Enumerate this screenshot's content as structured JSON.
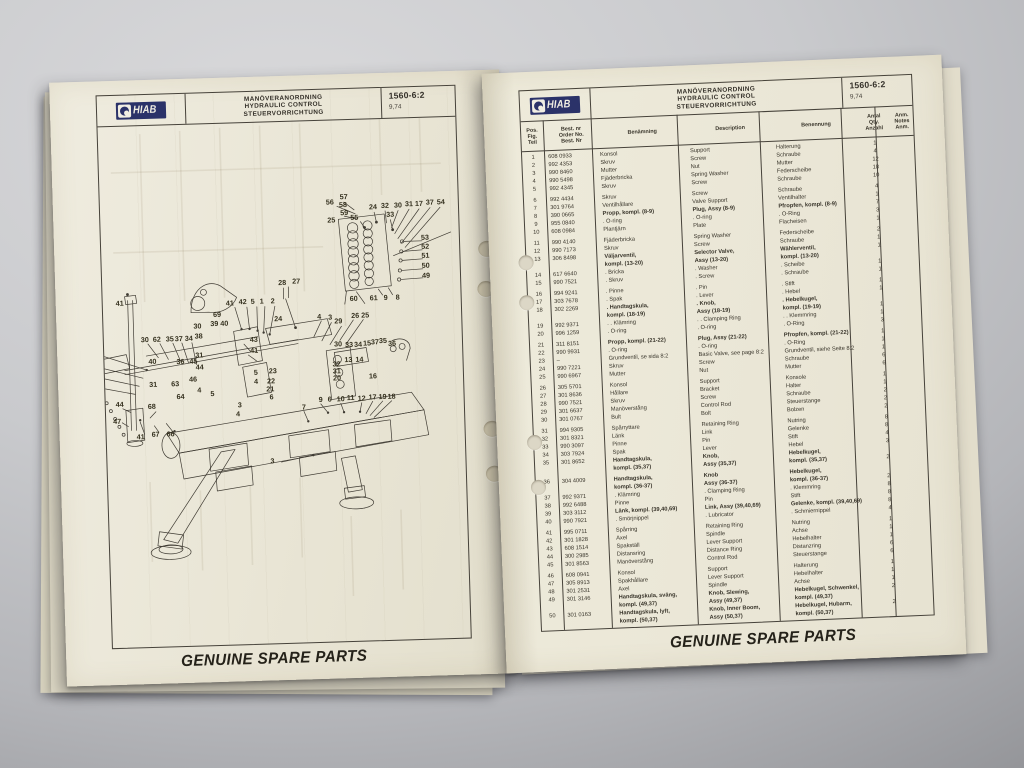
{
  "brand": {
    "logo_text": "HIAB",
    "logo_color": "#2b3269"
  },
  "header": {
    "title_sv": "MANÖVERANORDNING",
    "title_en": "HYDRAULIC CONTROL",
    "title_de": "STEUERVORRICHTUNG",
    "doc_no": "1560-6:2",
    "doc_date": "9,74"
  },
  "footer": {
    "slogan": "GENUINE SPARE PARTS"
  },
  "table": {
    "col_headers": {
      "pos": [
        "Pos.",
        "Fig.",
        "Teil"
      ],
      "no": [
        "Best. nr",
        "Order No.",
        "Best. Nr"
      ],
      "sv": "Benämning",
      "en": "Description",
      "de": "Benennung",
      "qty": [
        "Antal",
        "Qty.",
        "Anzahl"
      ],
      "anm": [
        "Anm.",
        "Notes",
        "Anm."
      ]
    },
    "rows": [
      {
        "pos": "1",
        "no": "608 0933",
        "sv": "Konsol",
        "en": "Support",
        "de": "Halterung",
        "qty": "1"
      },
      {
        "pos": "2",
        "no": "992 4353",
        "sv": "Skruv",
        "en": "Screw",
        "de": "Schraube",
        "qty": "4"
      },
      {
        "pos": "3",
        "no": "990 8460",
        "sv": "Mutter",
        "en": "Nut",
        "de": "Mutter",
        "qty": "12"
      },
      {
        "pos": "4",
        "no": "990 5498",
        "sv": "Fjäderbricka",
        "en": "Spring Washer",
        "de": "Federscheibe",
        "qty": "18"
      },
      {
        "pos": "5",
        "no": "992 4345",
        "sv": "Skruv",
        "en": "Screw",
        "de": "Schraube",
        "qty": "10"
      },
      {
        "gap": 1
      },
      {
        "pos": "6",
        "no": "992 4434",
        "sv": "Skruv",
        "en": "Screw",
        "de": "Schraube",
        "qty": "4"
      },
      {
        "pos": "7",
        "no": "301 9764",
        "sv": "Ventilhållare",
        "en": "Valve Support",
        "de": "Ventilhalter",
        "qty": "1"
      },
      {
        "pos": "8",
        "no": "390 0665",
        "sv": "Propp, kompl. (8-9)",
        "en": "Plug, Assy (8-9)",
        "de": "Pfropfen, kompl. (8-9)",
        "qty": "7",
        "b": 1
      },
      {
        "pos": "9",
        "no": "955 0840",
        "sv": ". O-ring",
        "en": ". O-ring",
        "de": ". O-Ring",
        "qty": "3"
      },
      {
        "pos": "10",
        "no": "608 0984",
        "sv": "Plantjärn",
        "en": "Plate",
        "de": "Flacheisen",
        "qty": "1"
      },
      {
        "gap": 1
      },
      {
        "pos": "11",
        "no": "990 4140",
        "sv": "Fjäderbricka",
        "en": "Spring Washer",
        "de": "Federscheibe",
        "qty": "2"
      },
      {
        "pos": "12",
        "no": "990 7173",
        "sv": "Skruv",
        "en": "Screw",
        "de": "Schraube",
        "qty": "1"
      },
      {
        "pos": "13",
        "no": "306 8498",
        "sv": "Väljarventil,",
        "en": "Selector Valve,",
        "de": "Wählerventil,",
        "qty": "1",
        "b": 1
      },
      {
        "pos": "",
        "no": "",
        "sv": "kompl. (13-20)",
        "en": "Assy (13-20)",
        "de": "kompl. (13-20)",
        "qty": "",
        "b": 1
      },
      {
        "pos": "14",
        "no": "617 6640",
        "sv": ". Bricka",
        "en": ". Washer",
        "de": ". Scheibe",
        "qty": "1"
      },
      {
        "pos": "15",
        "no": "990 7521",
        "sv": ". Skruv",
        "en": ". Screw",
        "de": ". Schraube",
        "qty": "1"
      },
      {
        "gap": 1
      },
      {
        "pos": "16",
        "no": "994 9241",
        "sv": ". Pinne",
        "en": ". Pin",
        "de": ". Stift",
        "qty": "1"
      },
      {
        "pos": "17",
        "no": "303 7678",
        "sv": ". Spak",
        "en": ". Lever",
        "de": ". Hebel",
        "qty": "1"
      },
      {
        "pos": "18",
        "no": "302 2269",
        "sv": ". Handtagskula,",
        "en": ". Knob,",
        "de": ". Hebelkugel,",
        "qty": "",
        "b": 1
      },
      {
        "pos": "",
        "no": "",
        "sv": "kompl. (18-19)",
        "en": "Assy (18-19)",
        "de": "kompl. (19-19)",
        "qty": "1",
        "b": 1
      },
      {
        "pos": "19",
        "no": "992 9371",
        "sv": ". . Klämring",
        "en": ". . Clamping Ring",
        "de": ". . Klemmring",
        "qty": "1"
      },
      {
        "pos": "20",
        "no": "996 1259",
        "sv": ". O-ring",
        "en": ". O-ring",
        "de": ". O-Ring",
        "qty": "3"
      },
      {
        "gap": 1
      },
      {
        "pos": "21",
        "no": "311 8151",
        "sv": "Propp, kompl. (21-22)",
        "en": "Plug, Assy (21-22)",
        "de": "Pfropfen, kompl. (21-22)",
        "qty": "1",
        "b": 1
      },
      {
        "pos": "22",
        "no": "990 9931",
        "sv": ". O-ring",
        "en": ". O-ring",
        "de": ". O-Ring",
        "qty": "1"
      },
      {
        "pos": "23",
        "no": "–",
        "sv": "Grundventil, se sida 8:2",
        "en": "Basic Valve, see page 8:2",
        "de": "Grundventil, siehe Seite 8:2",
        "qty": "1"
      },
      {
        "pos": "24",
        "no": "990 7221",
        "sv": "Skruv",
        "en": "Screw",
        "de": "Schraube",
        "qty": "6"
      },
      {
        "pos": "25",
        "no": "990 6967",
        "sv": "Mutter",
        "en": "Nut",
        "de": "Mutter",
        "qty": "6"
      },
      {
        "gap": 1
      },
      {
        "pos": "26",
        "no": "305 5701",
        "sv": "Konsol",
        "en": "Support",
        "de": "Konsole",
        "qty": "1"
      },
      {
        "pos": "27",
        "no": "301 8636",
        "sv": "Hållare",
        "en": "Bracket",
        "de": "Halter",
        "qty": "1"
      },
      {
        "pos": "28",
        "no": "990 7521",
        "sv": "Skruv",
        "en": "Screw",
        "de": "Schraube",
        "qty": "2"
      },
      {
        "pos": "29",
        "no": "301 6637",
        "sv": "Manöverstång",
        "en": "Control Rod",
        "de": "Steuerstange",
        "qty": "2"
      },
      {
        "pos": "30",
        "no": "301 0767",
        "sv": "Bult",
        "en": "Bolt",
        "de": "Bolzen",
        "qty": "2"
      },
      {
        "gap": 1
      },
      {
        "pos": "31",
        "no": "994 9305",
        "sv": "Spårryttare",
        "en": "Retaining Ring",
        "de": "Nutring",
        "qty": "8"
      },
      {
        "pos": "32",
        "no": "301 8321",
        "sv": "Länk",
        "en": "Link",
        "de": "Gelenke",
        "qty": "8"
      },
      {
        "pos": "33",
        "no": "990 3097",
        "sv": "Pinne",
        "en": "Pin",
        "de": "Stift",
        "qty": "4"
      },
      {
        "pos": "34",
        "no": "303 7924",
        "sv": "Spak",
        "en": "Lever",
        "de": "Hebel",
        "qty": "3"
      },
      {
        "pos": "35",
        "no": "301 8652",
        "sv": "Handtagskula,",
        "en": "Knob,",
        "de": "Hebelkugel,",
        "qty": "",
        "b": 1
      },
      {
        "pos": "",
        "no": "",
        "sv": "kompl. (35,37)",
        "en": "Assy (35,37)",
        "de": "kompl. (35,37)",
        "qty": "2",
        "b": 1
      },
      {
        "gap": 1
      },
      {
        "pos": "36",
        "no": "304 4009",
        "sv": "Handtagskula,",
        "en": "Knob",
        "de": "Hebelkugel,",
        "qty": "",
        "b": 1
      },
      {
        "pos": "",
        "no": "",
        "sv": "kompl. (36-37)",
        "en": "Assy (36-37)",
        "de": "kompl. (36-37)",
        "qty": "2",
        "b": 1
      },
      {
        "pos": "37",
        "no": "992 9371",
        "sv": ". Klämring",
        "en": ". Clamping Ring",
        "de": ". Klemmring",
        "qty": "8"
      },
      {
        "pos": "38",
        "no": "992 6488",
        "sv": "Pinne",
        "en": "Pin",
        "de": "Stift",
        "qty": "8"
      },
      {
        "pos": "39",
        "no": "303 3112",
        "sv": "Länk, kompl. (39,40,69)",
        "en": "Link, Assy (39,40,69)",
        "de": "Gelenke, kompl. (39,40,69)",
        "qty": "8",
        "b": 1
      },
      {
        "pos": "40",
        "no": "990 7921",
        "sv": ". Smörjnippel",
        "en": ". Lubricator",
        "de": ". Schmiernippel",
        "qty": "4"
      },
      {
        "gap": 1
      },
      {
        "pos": "41",
        "no": "995 0711",
        "sv": "Spårring",
        "en": "Retaining Ring",
        "de": "Nutring",
        "qty": "1"
      },
      {
        "pos": "42",
        "no": "301 1828",
        "sv": "Axel",
        "en": "Spindle",
        "de": "Achse",
        "qty": "1"
      },
      {
        "pos": "43",
        "no": "608 1514",
        "sv": "Spakställ",
        "en": "Lever Support",
        "de": "Hebelhalter",
        "qty": "1"
      },
      {
        "pos": "44",
        "no": "300 2985",
        "sv": "Distansring",
        "en": "Distance Ring",
        "de": "Distanzring",
        "qty": "6"
      },
      {
        "pos": "45",
        "no": "301 8563",
        "sv": "Manöverstång",
        "en": "Control Rod",
        "de": "Steuerstange",
        "qty": "6"
      },
      {
        "gap": 1
      },
      {
        "pos": "46",
        "no": "608 0941",
        "sv": "Konsol",
        "en": "Support",
        "de": "Halterung",
        "qty": "1"
      },
      {
        "pos": "47",
        "no": "305 8913",
        "sv": "Spakhållare",
        "en": "Lever Support",
        "de": "Hebelhalter",
        "qty": "1"
      },
      {
        "pos": "48",
        "no": "301 2531",
        "sv": "Axel",
        "en": "Spindle",
        "de": "Achse",
        "qty": "1"
      },
      {
        "pos": "49",
        "no": "301 3146",
        "sv": "Handtagskula, sväng,",
        "en": "Knob, Slewing,",
        "de": "Hebelkugel, Schwenkel,",
        "qty": "2",
        "b": 1
      },
      {
        "pos": "",
        "no": "",
        "sv": "kompl. (49,37)",
        "en": "Assy (49,37)",
        "de": "kompl. (49,37)",
        "qty": "",
        "b": 1
      },
      {
        "pos": "50",
        "no": "301 0163",
        "sv": "Handtagskula, lyft,",
        "en": "Knob, Inner Boom,",
        "de": "Hebelkugel, Hubarm,",
        "qty": "2",
        "b": 1
      },
      {
        "pos": "",
        "no": "",
        "sv": "kompl. (50,37)",
        "en": "Assy (50,37)",
        "de": "kompl. (50,37)",
        "qty": "",
        "b": 1
      }
    ]
  },
  "diagram": {
    "callouts": [
      {
        "t": "56",
        "x": 338,
        "y": 208
      },
      {
        "t": "57",
        "x": 352,
        "y": 203
      },
      {
        "t": "58",
        "x": 351,
        "y": 211
      },
      {
        "t": "59",
        "x": 352,
        "y": 219
      },
      {
        "t": "25",
        "x": 339,
        "y": 226
      },
      {
        "t": "55",
        "x": 362,
        "y": 224
      },
      {
        "t": "24",
        "x": 381,
        "y": 214
      },
      {
        "t": "32",
        "x": 393,
        "y": 213
      },
      {
        "t": "30",
        "x": 406,
        "y": 213
      },
      {
        "t": "31",
        "x": 417,
        "y": 212
      },
      {
        "t": "17",
        "x": 427,
        "y": 212
      },
      {
        "t": "37",
        "x": 438,
        "y": 211
      },
      {
        "t": "54",
        "x": 449,
        "y": 211
      },
      {
        "t": "33",
        "x": 398,
        "y": 222
      },
      {
        "t": "53",
        "x": 432,
        "y": 246
      },
      {
        "t": "52",
        "x": 432,
        "y": 255
      },
      {
        "t": "51",
        "x": 432,
        "y": 264
      },
      {
        "t": "50",
        "x": 432,
        "y": 274
      },
      {
        "t": "49",
        "x": 432,
        "y": 284
      },
      {
        "t": "60",
        "x": 359,
        "y": 305
      },
      {
        "t": "61",
        "x": 379,
        "y": 305
      },
      {
        "t": "9",
        "x": 391,
        "y": 305
      },
      {
        "t": "8",
        "x": 403,
        "y": 305
      },
      {
        "t": "28",
        "x": 288,
        "y": 287
      },
      {
        "t": "27",
        "x": 302,
        "y": 286
      },
      {
        "t": "41",
        "x": 125,
        "y": 303
      },
      {
        "t": "69",
        "x": 222,
        "y": 317
      },
      {
        "t": "41",
        "x": 235,
        "y": 306
      },
      {
        "t": "42",
        "x": 248,
        "y": 305
      },
      {
        "t": "5",
        "x": 258,
        "y": 305
      },
      {
        "t": "1",
        "x": 267,
        "y": 305
      },
      {
        "t": "2",
        "x": 278,
        "y": 305
      },
      {
        "t": "24",
        "x": 283,
        "y": 323
      },
      {
        "t": "30",
        "x": 202,
        "y": 328
      },
      {
        "t": "39",
        "x": 219,
        "y": 326
      },
      {
        "t": "40",
        "x": 229,
        "y": 326
      },
      {
        "t": "38",
        "x": 203,
        "y": 338
      },
      {
        "t": "4",
        "x": 324,
        "y": 322
      },
      {
        "t": "3",
        "x": 335,
        "y": 323
      },
      {
        "t": "29",
        "x": 343,
        "y": 327
      },
      {
        "t": "26",
        "x": 360,
        "y": 322
      },
      {
        "t": "25",
        "x": 370,
        "y": 322
      },
      {
        "t": "30",
        "x": 149,
        "y": 340
      },
      {
        "t": "62",
        "x": 161,
        "y": 340
      },
      {
        "t": "35",
        "x": 174,
        "y": 340
      },
      {
        "t": "37",
        "x": 183,
        "y": 340
      },
      {
        "t": "34",
        "x": 193,
        "y": 340
      },
      {
        "t": "48",
        "x": 100,
        "y": 351
      },
      {
        "t": "38",
        "x": 99,
        "y": 364
      },
      {
        "t": "39",
        "x": 98,
        "y": 374
      },
      {
        "t": "65",
        "x": 97,
        "y": 383
      },
      {
        "t": "17",
        "x": 95,
        "y": 394
      },
      {
        "t": "40",
        "x": 156,
        "y": 362
      },
      {
        "t": "36",
        "x": 184,
        "y": 363
      },
      {
        "t": "45",
        "x": 197,
        "y": 363
      },
      {
        "t": "44",
        "x": 203,
        "y": 369
      },
      {
        "t": "31",
        "x": 203,
        "y": 357
      },
      {
        "t": "43",
        "x": 258,
        "y": 343
      },
      {
        "t": "41",
        "x": 258,
        "y": 354
      },
      {
        "t": "30",
        "x": 342,
        "y": 350
      },
      {
        "t": "33",
        "x": 353,
        "y": 351
      },
      {
        "t": "34",
        "x": 362,
        "y": 351
      },
      {
        "t": "15",
        "x": 371,
        "y": 350
      },
      {
        "t": "37",
        "x": 379,
        "y": 349
      },
      {
        "t": "35",
        "x": 387,
        "y": 348
      },
      {
        "t": "36",
        "x": 396,
        "y": 351
      },
      {
        "t": "13",
        "x": 352,
        "y": 366
      },
      {
        "t": "14",
        "x": 363,
        "y": 366
      },
      {
        "t": "32",
        "x": 340,
        "y": 370
      },
      {
        "t": "31",
        "x": 340,
        "y": 377
      },
      {
        "t": "20",
        "x": 340,
        "y": 384
      },
      {
        "t": "16",
        "x": 376,
        "y": 383
      },
      {
        "t": "23",
        "x": 276,
        "y": 375
      },
      {
        "t": "22",
        "x": 274,
        "y": 385
      },
      {
        "t": "21",
        "x": 273,
        "y": 393
      },
      {
        "t": "6",
        "x": 274,
        "y": 401
      },
      {
        "t": "5",
        "x": 259,
        "y": 376
      },
      {
        "t": "4",
        "x": 259,
        "y": 385
      },
      {
        "t": "63",
        "x": 178,
        "y": 385
      },
      {
        "t": "46",
        "x": 196,
        "y": 381
      },
      {
        "t": "31",
        "x": 156,
        "y": 385
      },
      {
        "t": "64",
        "x": 183,
        "y": 398
      },
      {
        "t": "4",
        "x": 202,
        "y": 392
      },
      {
        "t": "5",
        "x": 215,
        "y": 396
      },
      {
        "t": "37",
        "x": 94,
        "y": 404
      },
      {
        "t": "54",
        "x": 95,
        "y": 414
      },
      {
        "t": "53",
        "x": 94,
        "y": 425
      },
      {
        "t": "52",
        "x": 93,
        "y": 435
      },
      {
        "t": "51",
        "x": 92,
        "y": 444
      },
      {
        "t": "50",
        "x": 91,
        "y": 453
      },
      {
        "t": "49",
        "x": 91,
        "y": 463
      },
      {
        "t": "44",
        "x": 122,
        "y": 404
      },
      {
        "t": "47",
        "x": 119,
        "y": 421
      },
      {
        "t": "68",
        "x": 154,
        "y": 407
      },
      {
        "t": "41",
        "x": 142,
        "y": 437
      },
      {
        "t": "67",
        "x": 157,
        "y": 435
      },
      {
        "t": "66",
        "x": 172,
        "y": 435
      },
      {
        "t": "3",
        "x": 242,
        "y": 408
      },
      {
        "t": "4",
        "x": 240,
        "y": 417
      },
      {
        "t": "7",
        "x": 306,
        "y": 412
      },
      {
        "t": "9",
        "x": 323,
        "y": 405
      },
      {
        "t": "6",
        "x": 332,
        "y": 405
      },
      {
        "t": "10",
        "x": 343,
        "y": 405
      },
      {
        "t": "11",
        "x": 353,
        "y": 404
      },
      {
        "t": "12",
        "x": 364,
        "y": 405
      },
      {
        "t": "17",
        "x": 375,
        "y": 404
      },
      {
        "t": "19",
        "x": 385,
        "y": 404
      },
      {
        "t": "18",
        "x": 394,
        "y": 404
      },
      {
        "t": "3",
        "x": 273,
        "y": 465
      }
    ]
  }
}
